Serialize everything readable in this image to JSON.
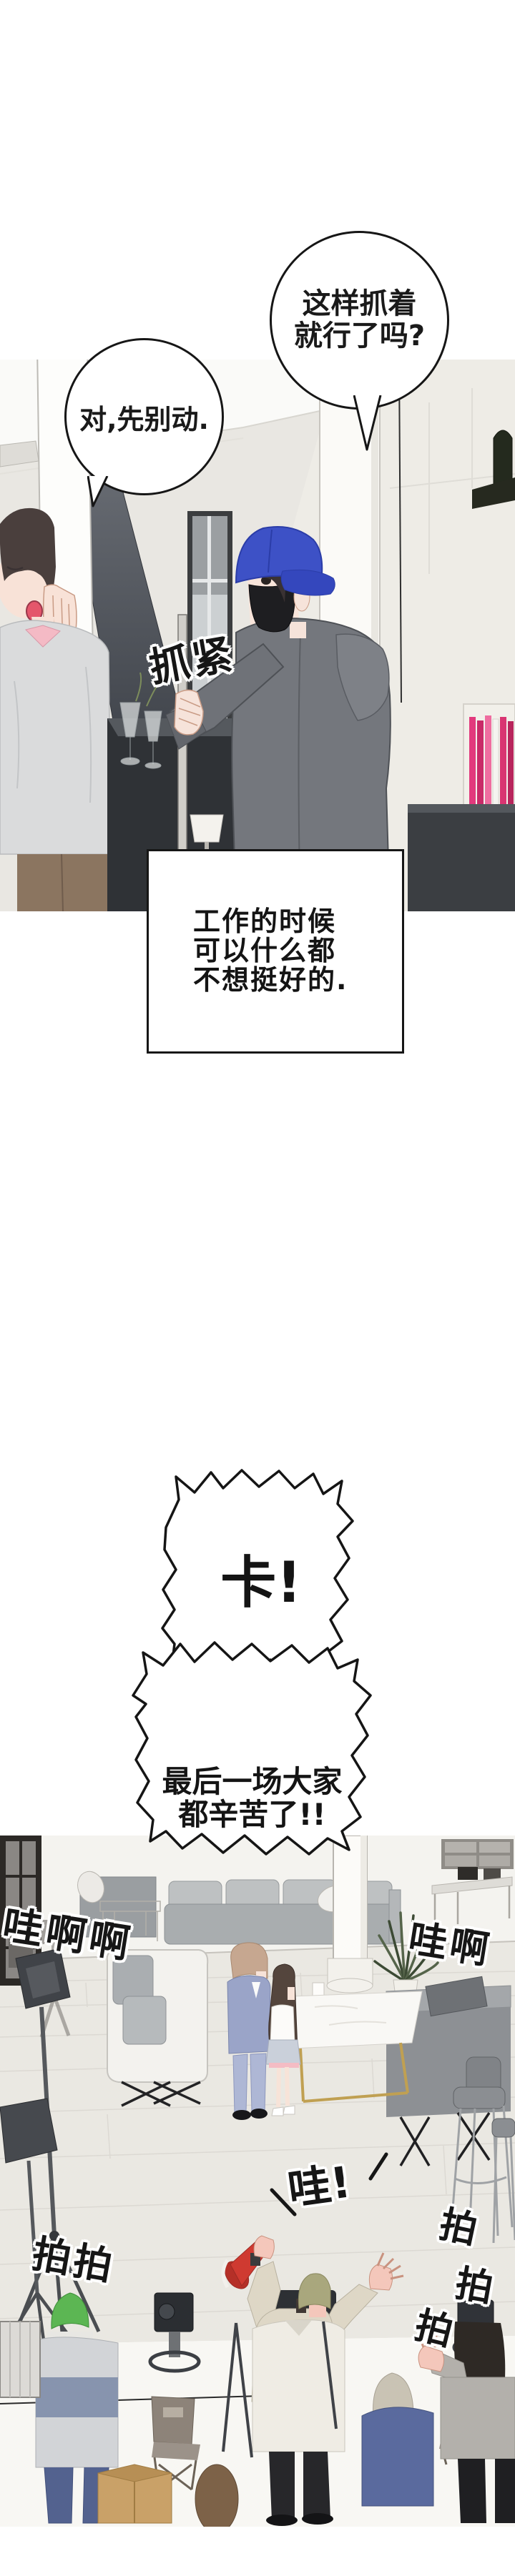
{
  "speech": {
    "bubble_right": {
      "line1": "这样抓着",
      "line2": "就行了吗?"
    },
    "bubble_left": {
      "text": "对,先别动."
    },
    "shout_cut": {
      "text": "卡!"
    },
    "shout_wrap": {
      "line1": "最后一场大家",
      "line2": "都辛苦了!!"
    }
  },
  "caption": {
    "line1": "工作的时候",
    "line2": "可以什么都",
    "line3": "不想挺好的."
  },
  "sfx": {
    "grab_tight": "抓紧",
    "cheer_left": "哇啊啊",
    "cheer_right": "哇啊",
    "wow": "哇!",
    "clap_left": "拍拍",
    "clap_right_1": "拍",
    "clap_right_2": "拍",
    "clap_right_3": "拍"
  },
  "colors": {
    "ink": "#161616",
    "cap_blue": "#3d51c6",
    "hoodie_grey": "#74777d",
    "sweater_grey": "#dadbdc",
    "collar_pink": "#f4bac5",
    "books_pink": "#e23a7d",
    "suit_lavender": "#9aa4c8",
    "megaphone_red": "#cf3a31",
    "beanie_khaki": "#a9a77d",
    "cap_green": "#5cb653",
    "wall_grey": "#e9e7e2",
    "floor_wood": "#eae8e2"
  }
}
